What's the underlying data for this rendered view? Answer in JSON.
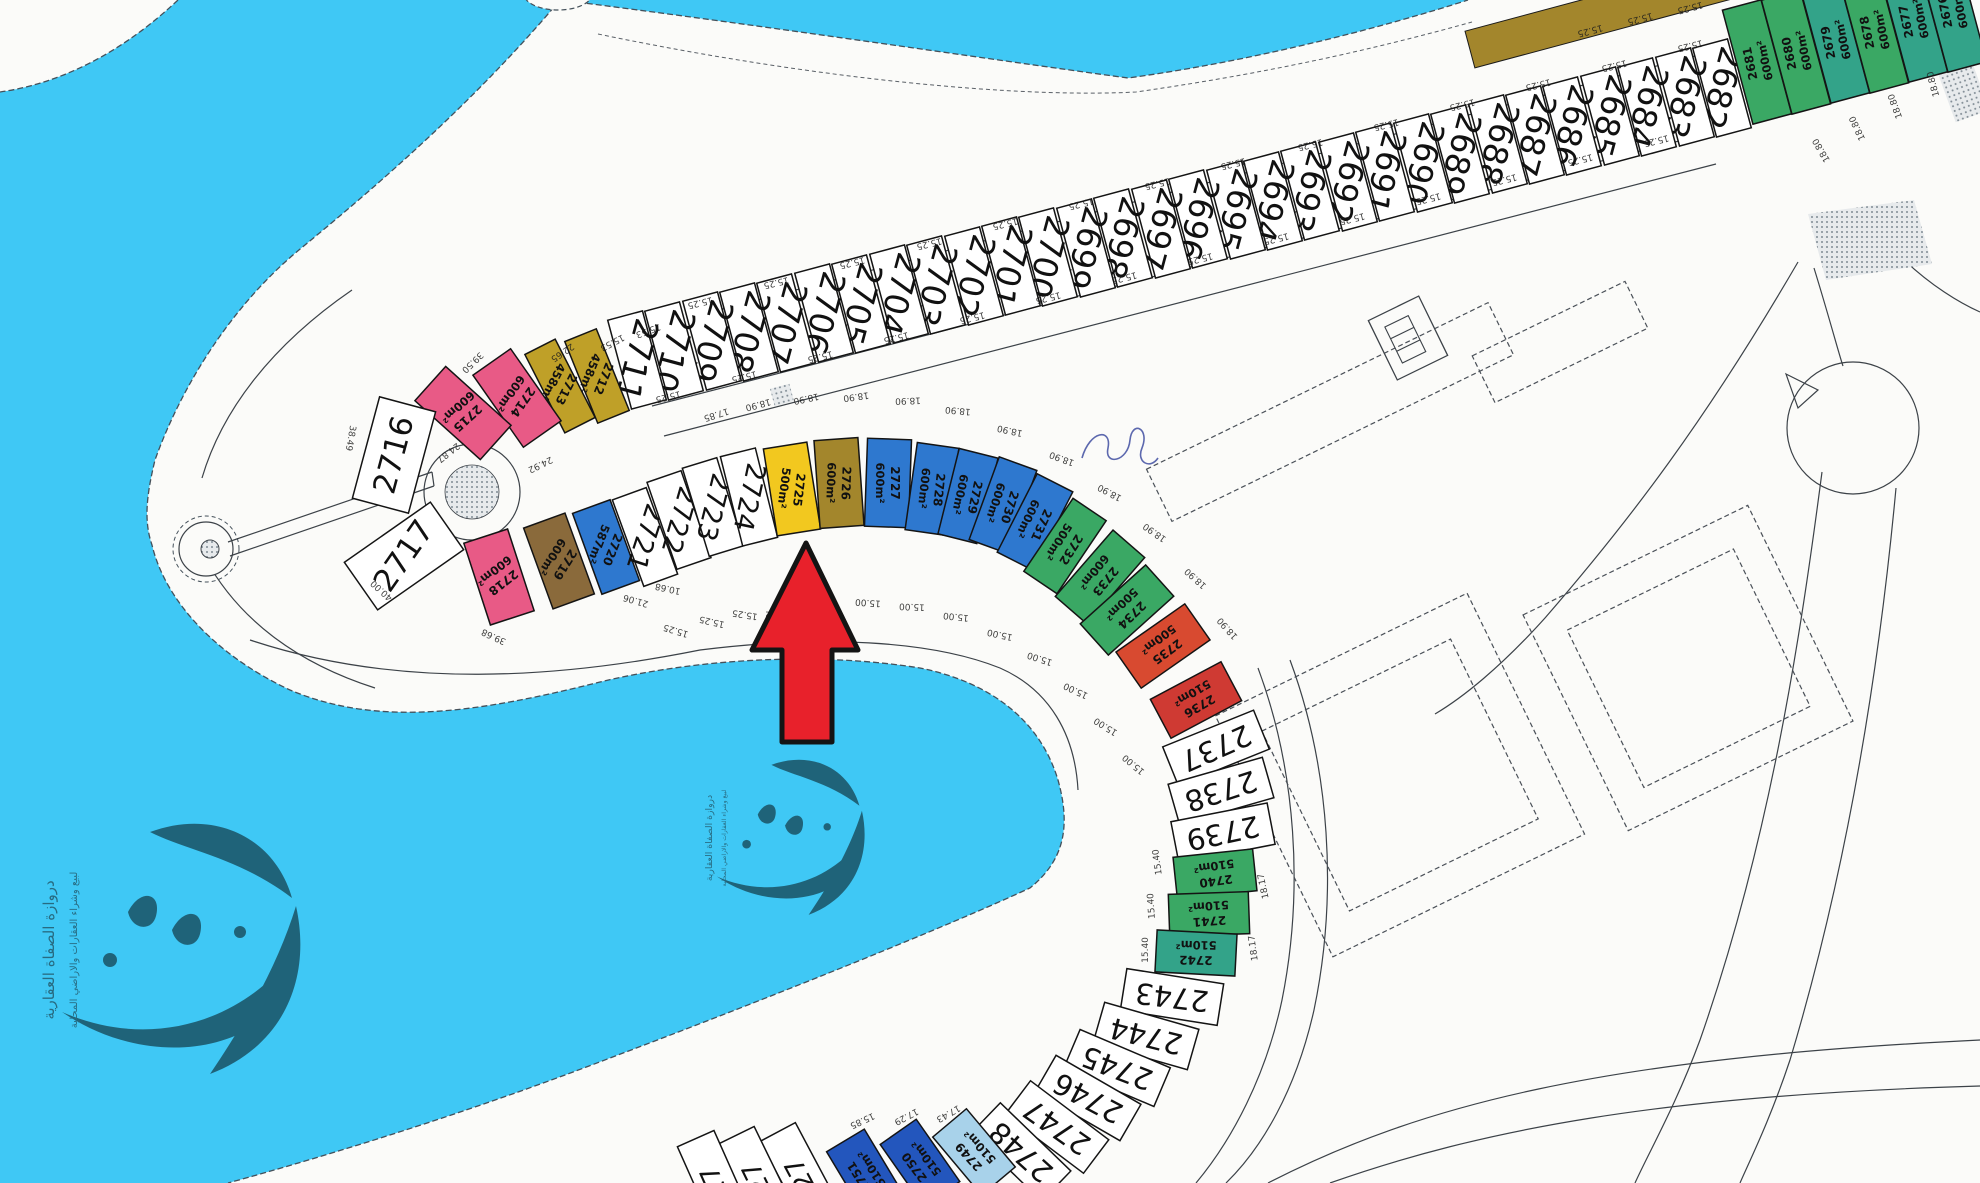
{
  "map": {
    "title": "plot-site-plan",
    "colors": {
      "water": "#3fc8f5",
      "land": "#fbfbf9",
      "arrow": "#e8212b",
      "arrow_outline": "#141414",
      "white": "#ffffff",
      "pink": "#e85a86",
      "gold": "#bfa028",
      "yellow": "#f2c81f",
      "olive": "#a3862c",
      "blue": "#2e78cf",
      "blue2": "#2356bd",
      "lightblue": "#a8d2ea",
      "green": "#3aa864",
      "teal": "#33a389",
      "red": "#d84a30",
      "red2": "#cf3a33",
      "brown": "#8a6a3b",
      "watermark": "#67abc6",
      "scribble": "#35439b"
    },
    "watermark": {
      "line1": "دروازة الصفاة العقارية",
      "line2": "لبيع وشراء العقارات والاراضي المحلية"
    },
    "arrow_points": "806,543 752,650 782,650 782,742 832,742 832,650 858,650",
    "plots_format": [
      "number",
      "x",
      "y",
      "rect_rot",
      "label_rot",
      "w",
      "h",
      "color",
      "area",
      "num_font_size"
    ],
    "plots": [
      [
        "2682",
        1722,
        88,
        -15,
        105,
        36,
        92,
        "white",
        "",
        33
      ],
      [
        "2683",
        1685,
        97,
        -15,
        105,
        36,
        92,
        "white",
        "",
        33
      ],
      [
        "2684",
        1647,
        107,
        -15,
        105,
        36,
        92,
        "white",
        "",
        33
      ],
      [
        "2685",
        1610,
        116,
        -15,
        105,
        36,
        92,
        "white",
        "",
        33
      ],
      [
        "2686",
        1572,
        126,
        -15,
        105,
        36,
        92,
        "white",
        "",
        33
      ],
      [
        "2687",
        1535,
        135,
        -15,
        105,
        36,
        92,
        "white",
        "",
        33
      ],
      [
        "2688",
        1498,
        144,
        -15,
        105,
        36,
        92,
        "white",
        "",
        33
      ],
      [
        "2689",
        1460,
        154,
        -15,
        105,
        36,
        92,
        "white",
        "",
        33
      ],
      [
        "2690",
        1423,
        163,
        -15,
        105,
        36,
        92,
        "white",
        "",
        33
      ],
      [
        "2691",
        1385,
        172,
        -15,
        105,
        36,
        92,
        "white",
        "",
        33
      ],
      [
        "2692",
        1348,
        182,
        -15,
        105,
        36,
        92,
        "white",
        "",
        33
      ],
      [
        "2693",
        1310,
        191,
        -15,
        105,
        36,
        92,
        "white",
        "",
        33
      ],
      [
        "2694",
        1273,
        201,
        -15,
        105,
        36,
        92,
        "white",
        "",
        33
      ],
      [
        "2695",
        1236,
        210,
        -15,
        105,
        36,
        92,
        "white",
        "",
        33
      ],
      [
        "2696",
        1198,
        219,
        -15,
        105,
        36,
        92,
        "white",
        "",
        33
      ],
      [
        "2697",
        1161,
        229,
        -15,
        105,
        36,
        92,
        "white",
        "",
        33
      ],
      [
        "2698",
        1123,
        238,
        -15,
        105,
        36,
        92,
        "white",
        "",
        33
      ],
      [
        "2699",
        1086,
        248,
        -15,
        105,
        36,
        92,
        "white",
        "",
        33
      ],
      [
        "2700",
        1048,
        257,
        -15,
        105,
        36,
        92,
        "white",
        "",
        33
      ],
      [
        "2701",
        1011,
        266,
        -15,
        105,
        36,
        92,
        "white",
        "",
        33
      ],
      [
        "2702",
        974,
        276,
        -15,
        105,
        36,
        92,
        "white",
        "",
        33
      ],
      [
        "2703",
        936,
        285,
        -15,
        105,
        36,
        92,
        "white",
        "",
        33
      ],
      [
        "2704",
        899,
        294,
        -15,
        105,
        36,
        92,
        "white",
        "",
        33
      ],
      [
        "2705",
        861,
        304,
        -15,
        105,
        36,
        92,
        "white",
        "",
        33
      ],
      [
        "2706",
        824,
        313,
        -15,
        105,
        36,
        92,
        "white",
        "",
        33
      ],
      [
        "2707",
        786,
        323,
        -15,
        105,
        36,
        92,
        "white",
        "",
        33
      ],
      [
        "2708",
        749,
        332,
        -15,
        105,
        36,
        92,
        "white",
        "",
        33
      ],
      [
        "2709",
        712,
        341,
        -15,
        105,
        36,
        92,
        "white",
        "",
        33
      ],
      [
        "2710",
        674,
        351,
        -15,
        105,
        36,
        92,
        "white",
        "",
        33
      ],
      [
        "2711",
        637,
        360,
        -15,
        105,
        36,
        92,
        "white",
        "",
        33
      ],
      [
        "2681",
        1757,
        62,
        -15,
        258,
        40,
        118,
        "green",
        "600m²",
        12
      ],
      [
        "2680",
        1796,
        52,
        -15,
        258,
        40,
        118,
        "green",
        "600m²",
        12
      ],
      [
        "2679",
        1835,
        41,
        -15,
        258,
        40,
        118,
        "teal",
        "600m²",
        12
      ],
      [
        "2678",
        1874,
        31,
        -15,
        258,
        40,
        118,
        "green",
        "600m²",
        12
      ],
      [
        "2677",
        1913,
        20,
        -15,
        258,
        40,
        118,
        "teal",
        "600m²",
        12
      ],
      [
        "2676",
        1952,
        10,
        -15,
        258,
        40,
        118,
        "teal",
        "600m²",
        12
      ],
      [
        "2712",
        597,
        376,
        -22,
        112,
        34,
        88,
        "gold",
        "458m²",
        12
      ],
      [
        "2713",
        560,
        386,
        -27,
        117,
        34,
        88,
        "gold",
        "458m²",
        12
      ],
      [
        "2714",
        517,
        398,
        -35,
        125,
        46,
        88,
        "pink",
        "600m²",
        12
      ],
      [
        "2715",
        463,
        413,
        -48,
        138,
        46,
        88,
        "pink",
        "600m²",
        12
      ],
      [
        "2716",
        394,
        455,
        15,
        -75,
        58,
        105,
        "white",
        "",
        31
      ],
      [
        "2717",
        404,
        556,
        55,
        -55,
        58,
        105,
        "white",
        "",
        31
      ],
      [
        "2718",
        499,
        577,
        -18,
        142,
        46,
        86,
        "pink",
        "600m²",
        12
      ],
      [
        "2719",
        559,
        561,
        -20,
        122,
        44,
        86,
        "brown",
        "600m²",
        12
      ],
      [
        "2720",
        606,
        547,
        -20,
        112,
        40,
        86,
        "blue",
        "587m²",
        12
      ],
      [
        "2721",
        645,
        537,
        -20,
        108,
        36,
        92,
        "white",
        "",
        27
      ],
      [
        "2722",
        679,
        520,
        -19,
        106,
        36,
        92,
        "white",
        "",
        27
      ],
      [
        "2723",
        713,
        507,
        -17,
        104,
        36,
        92,
        "white",
        "",
        27
      ],
      [
        "2724",
        749,
        497,
        -14,
        102,
        36,
        92,
        "white",
        "",
        27
      ],
      [
        "2725",
        792,
        489,
        -9,
        97,
        44,
        88,
        "yellow",
        "500m²",
        12
      ],
      [
        "2726",
        839,
        483,
        -4,
        92,
        44,
        88,
        "olive",
        "600m²",
        12
      ],
      [
        "2727",
        888,
        483,
        2,
        90,
        44,
        88,
        "blue",
        "600m²",
        12
      ],
      [
        "2728",
        932,
        489,
        8,
        96,
        42,
        88,
        "blue",
        "600m²",
        12
      ],
      [
        "2729",
        968,
        496,
        14,
        102,
        40,
        88,
        "blue",
        "600m²",
        12
      ],
      [
        "2730",
        1003,
        505,
        20,
        108,
        40,
        88,
        "blue",
        "600m²",
        12
      ],
      [
        "2731",
        1035,
        522,
        27,
        115,
        40,
        88,
        "blue",
        "600m²",
        12
      ],
      [
        "2732",
        1065,
        546,
        34,
        122,
        40,
        88,
        "green",
        "500m²",
        12
      ],
      [
        "2733",
        1100,
        577,
        41,
        129,
        42,
        88,
        "green",
        "600m²",
        12
      ],
      [
        "2734",
        1127,
        610,
        48,
        136,
        42,
        88,
        "green",
        "500m²",
        12
      ],
      [
        "2735",
        1163,
        646,
        55,
        143,
        44,
        84,
        "red",
        "500m²",
        12
      ],
      [
        "2736",
        1196,
        700,
        62,
        150,
        44,
        80,
        "red2",
        "510m²",
        12
      ],
      [
        "2737",
        1216,
        748,
        68,
        156,
        42,
        98,
        "white",
        "",
        29
      ],
      [
        "2738",
        1221,
        791,
        74,
        162,
        42,
        98,
        "white",
        "",
        29
      ],
      [
        "2739",
        1223,
        833,
        79,
        168,
        42,
        98,
        "white",
        "",
        29
      ],
      [
        "2740",
        1215,
        874,
        84,
        172,
        42,
        80,
        "green",
        "510m²",
        12
      ],
      [
        "2741",
        1209,
        914,
        88,
        176,
        42,
        80,
        "green",
        "510m²",
        12
      ],
      [
        "2742",
        1196,
        953,
        93,
        181,
        42,
        80,
        "teal",
        "510m²",
        12
      ],
      [
        "2743",
        1172,
        997,
        99,
        187,
        42,
        98,
        "white",
        "",
        29
      ],
      [
        "2744",
        1146,
        1036,
        106,
        194,
        42,
        98,
        "white",
        "",
        29
      ],
      [
        "2745",
        1117,
        1068,
        113,
        201,
        42,
        98,
        "white",
        "",
        29
      ],
      [
        "2746",
        1088,
        1098,
        120,
        208,
        42,
        98,
        "white",
        "",
        29
      ],
      [
        "2747",
        1057,
        1127,
        127,
        215,
        42,
        98,
        "white",
        "",
        29
      ],
      [
        "2748",
        1021,
        1152,
        134,
        222,
        42,
        98,
        "white",
        "",
        29
      ],
      [
        "2749",
        974,
        1152,
        140,
        228,
        44,
        76,
        "lightblue",
        "510m²",
        12
      ],
      [
        "2750",
        920,
        1163,
        145,
        233,
        44,
        76,
        "blue2",
        "510m²",
        12
      ],
      [
        "2751",
        865,
        1173,
        149,
        237,
        44,
        76,
        "blue2",
        "510m²",
        12
      ],
      [
        "27",
        800,
        1174,
        152,
        242,
        40,
        95,
        "white",
        "",
        26
      ],
      [
        "27",
        757,
        1178,
        154,
        244,
        40,
        95,
        "white",
        "",
        26
      ],
      [
        "27",
        715,
        1182,
        156,
        246,
        40,
        95,
        "white",
        "",
        26
      ]
    ],
    "dims_format": [
      "text",
      "x",
      "y",
      "rot"
    ],
    "dims": [
      [
        "15.25",
        700,
        302,
        166
      ],
      [
        "15.25",
        776,
        282,
        166
      ],
      [
        "15.25",
        852,
        262,
        166
      ],
      [
        "15.25",
        929,
        243,
        166
      ],
      [
        "15.25",
        1005,
        223,
        166
      ],
      [
        "15.25",
        1081,
        203,
        166
      ],
      [
        "15.25",
        1157,
        183,
        166
      ],
      [
        "15.25",
        1233,
        163,
        166
      ],
      [
        "15.25",
        1310,
        144,
        166
      ],
      [
        "15.25",
        1386,
        124,
        166
      ],
      [
        "15.25",
        1462,
        104,
        166
      ],
      [
        "15.25",
        1538,
        84,
        166
      ],
      [
        "15.25",
        1614,
        65,
        166
      ],
      [
        "15.25",
        1690,
        45,
        166
      ],
      [
        "15.25",
        668,
        396,
        166
      ],
      [
        "15.25",
        744,
        376,
        166
      ],
      [
        "15.25",
        820,
        356,
        166
      ],
      [
        "15.25",
        896,
        337,
        166
      ],
      [
        "15.25",
        972,
        317,
        166
      ],
      [
        "15.25",
        1048,
        297,
        166
      ],
      [
        "15.25",
        1124,
        277,
        166
      ],
      [
        "15.25",
        1200,
        258,
        166
      ],
      [
        "15.25",
        1276,
        238,
        166
      ],
      [
        "15.25",
        1352,
        218,
        166
      ],
      [
        "15.25",
        1428,
        198,
        166
      ],
      [
        "15.25",
        1504,
        179,
        166
      ],
      [
        "15.25",
        1580,
        159,
        166
      ],
      [
        "15.25",
        1656,
        140,
        166
      ],
      [
        "15.25",
        1590,
        30,
        165
      ],
      [
        "15.25",
        1640,
        18,
        165
      ],
      [
        "15.25",
        1690,
        7,
        165
      ],
      [
        "18.80",
        1822,
        150,
        240
      ],
      [
        "18.80",
        1858,
        128,
        245
      ],
      [
        "18.80",
        1896,
        106,
        250
      ],
      [
        "18.80",
        1934,
        84,
        255
      ],
      [
        "18.90",
        758,
        404,
        165
      ],
      [
        "18.90",
        806,
        398,
        168
      ],
      [
        "18.90",
        856,
        396,
        172
      ],
      [
        "18.90",
        908,
        400,
        178
      ],
      [
        "18.90",
        958,
        410,
        185
      ],
      [
        "18.90",
        1010,
        430,
        192
      ],
      [
        "18.90",
        1062,
        458,
        200
      ],
      [
        "18.90",
        1110,
        492,
        208
      ],
      [
        "18.90",
        1155,
        532,
        215
      ],
      [
        "18.90",
        1196,
        578,
        222
      ],
      [
        "18.90",
        1228,
        628,
        228
      ],
      [
        "17.85",
        716,
        414,
        162
      ],
      [
        "15.00",
        822,
        606,
        188
      ],
      [
        "15.00",
        868,
        602,
        184
      ],
      [
        "15.00",
        912,
        606,
        182
      ],
      [
        "15.00",
        956,
        616,
        186
      ],
      [
        "15.00",
        1000,
        634,
        192
      ],
      [
        "15.00",
        1040,
        658,
        198
      ],
      [
        "15.00",
        1076,
        690,
        205
      ],
      [
        "15.00",
        1106,
        726,
        212
      ],
      [
        "15.00",
        1134,
        764,
        220
      ],
      [
        "16.22",
        778,
        614,
        182
      ],
      [
        "15.25",
        676,
        630,
        197
      ],
      [
        "15.25",
        712,
        621,
        193
      ],
      [
        "15.25",
        745,
        614,
        189
      ],
      [
        "15.53",
        648,
        330,
        160
      ],
      [
        "15.53",
        612,
        342,
        152
      ],
      [
        "22.65",
        562,
        352,
        146
      ],
      [
        "39.50",
        472,
        362,
        136
      ],
      [
        "24.92",
        540,
        464,
        154
      ],
      [
        "24.87",
        448,
        452,
        142
      ],
      [
        "38.49",
        350,
        438,
        100
      ],
      [
        "39.68",
        494,
        636,
        205
      ],
      [
        "40.00",
        382,
        590,
        222
      ],
      [
        "21.06",
        636,
        600,
        196
      ],
      [
        "10.68",
        668,
        588,
        192
      ],
      [
        "15.40",
        1158,
        862,
        262
      ],
      [
        "15.40",
        1152,
        906,
        266
      ],
      [
        "15.40",
        1146,
        950,
        270
      ],
      [
        "18.17",
        1264,
        886,
        258
      ],
      [
        "18.17",
        1254,
        948,
        262
      ],
      [
        "15.85",
        862,
        1120,
        155
      ],
      [
        "17.29",
        906,
        1116,
        152
      ],
      [
        "17.43",
        948,
        1113,
        150
      ]
    ]
  }
}
